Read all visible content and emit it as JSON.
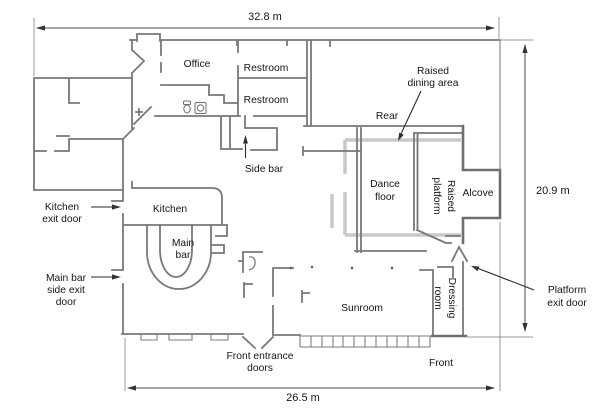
{
  "title": "Nightclub floor plan",
  "dimensions": {
    "top": "32.8 m",
    "right": "20.9 m",
    "bottom": "26.5 m"
  },
  "rooms": {
    "office": "Office",
    "restroom_upper": "Restroom",
    "restroom_lower": "Restroom",
    "side_bar": "Side bar",
    "kitchen": "Kitchen",
    "main_bar": [
      "Main",
      "bar"
    ],
    "rear": "Rear",
    "dance_floor": [
      "Dance",
      "floor"
    ],
    "raised_platform": [
      "Raised",
      "platform"
    ],
    "alcove": "Alcove",
    "sunroom": "Sunroom",
    "dressing_room": [
      "Dressing",
      "room"
    ],
    "front": "Front"
  },
  "callouts": {
    "kitchen_exit": [
      "Kitchen",
      "exit door"
    ],
    "main_bar_exit": [
      "Main bar",
      "side exit",
      "door"
    ],
    "raised_dining": [
      "Raised",
      "dining area"
    ],
    "platform_exit": [
      "Platform",
      "exit door"
    ],
    "front_entrance": [
      "Front entrance",
      "doors"
    ]
  },
  "colors": {
    "wall": "#787878",
    "platform_outline": "#c9c9c9",
    "text": "#161616",
    "arrow": "#333333",
    "background": "#ffffff"
  }
}
